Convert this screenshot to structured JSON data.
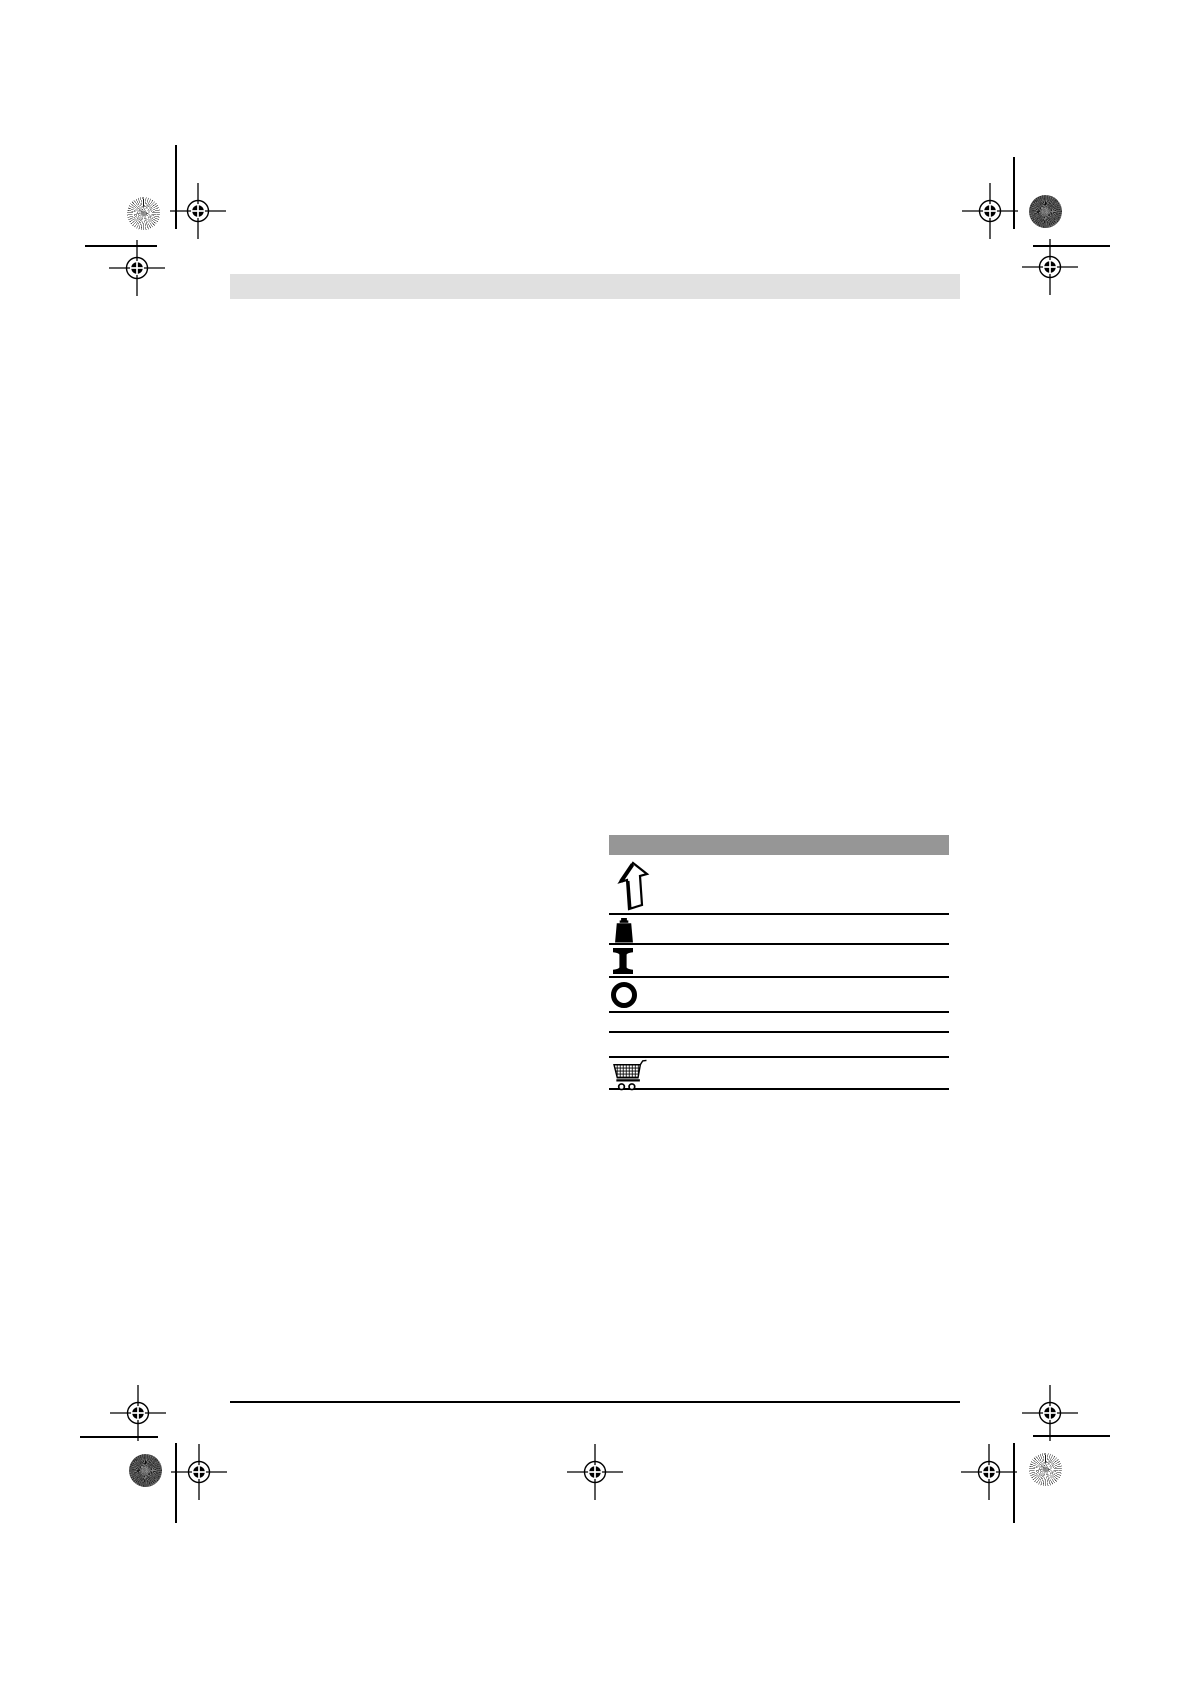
{
  "page": {
    "background_color": "#ffffff"
  },
  "header_bar": {
    "label": "",
    "background_color": "#e0e0e0"
  },
  "symbols_table": {
    "header_label": "",
    "header_background_color": "#969696",
    "border_color": "#000000",
    "rows": [
      {
        "icon": "direction-arrow-icon",
        "label": ""
      },
      {
        "icon": "weight-icon",
        "label": ""
      },
      {
        "icon": "capital-i-symbol-icon",
        "label": ""
      },
      {
        "icon": "capital-o-symbol-icon",
        "label": ""
      },
      {
        "icon": "",
        "label": ""
      },
      {
        "icon": "",
        "label": ""
      },
      {
        "icon": "shopping-cart-icon",
        "label": ""
      }
    ]
  },
  "icon_glyphs": {
    "direction_arrow": "⇧",
    "weight": "⏏",
    "capital_i": "I",
    "capital_o": "O",
    "shopping_cart": "🛒"
  },
  "printer_marks": {
    "mark_color": "#000000",
    "registration_marks": [
      "top-left-outer",
      "top-left-inner",
      "top-right-outer",
      "top-right-inner",
      "bottom-left-upper",
      "bottom-left-lower",
      "bottom-center",
      "bottom-right-upper",
      "bottom-right-lower"
    ],
    "color_patches": [
      "top-left-starburst",
      "top-right-granite",
      "bottom-left-granite",
      "bottom-right-starburst"
    ]
  },
  "footer_rule": {
    "color": "#000000"
  }
}
